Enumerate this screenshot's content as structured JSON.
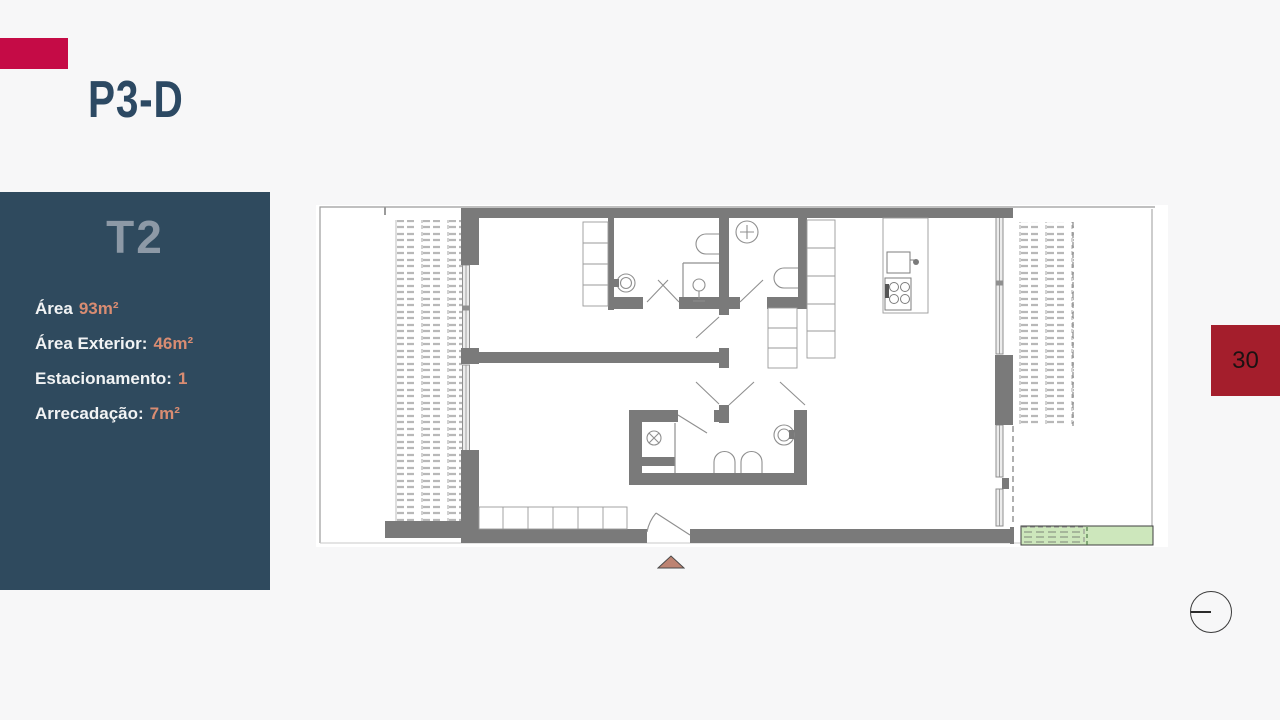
{
  "slide": {
    "title": "P3-D",
    "page_number": "30"
  },
  "unit_panel": {
    "unit_type": "T2",
    "specs": [
      {
        "label": "Área",
        "value": "93m²"
      },
      {
        "label": "Área Exterior:",
        "value": "46m²"
      },
      {
        "label": "Estacionamento:",
        "value": "1"
      },
      {
        "label": "Arrecadação:",
        "value": "7m²"
      }
    ]
  },
  "icons": {
    "entrance_marker": "triangle-up-icon",
    "corner_circle": "circle-line-icon"
  },
  "colors": {
    "bg_color": "#f7f7f8",
    "accent_red": "#c50b46",
    "page_red": "#a41e2c",
    "navy": "#2f4a5e",
    "heading_navy": "#2c4963",
    "t2_gray": "#8d99a6",
    "salmon": "#d98c72",
    "wall_gray": "#7a7a7a",
    "plan_green": "#cde7bc",
    "marker_fill": "#bd8372"
  }
}
